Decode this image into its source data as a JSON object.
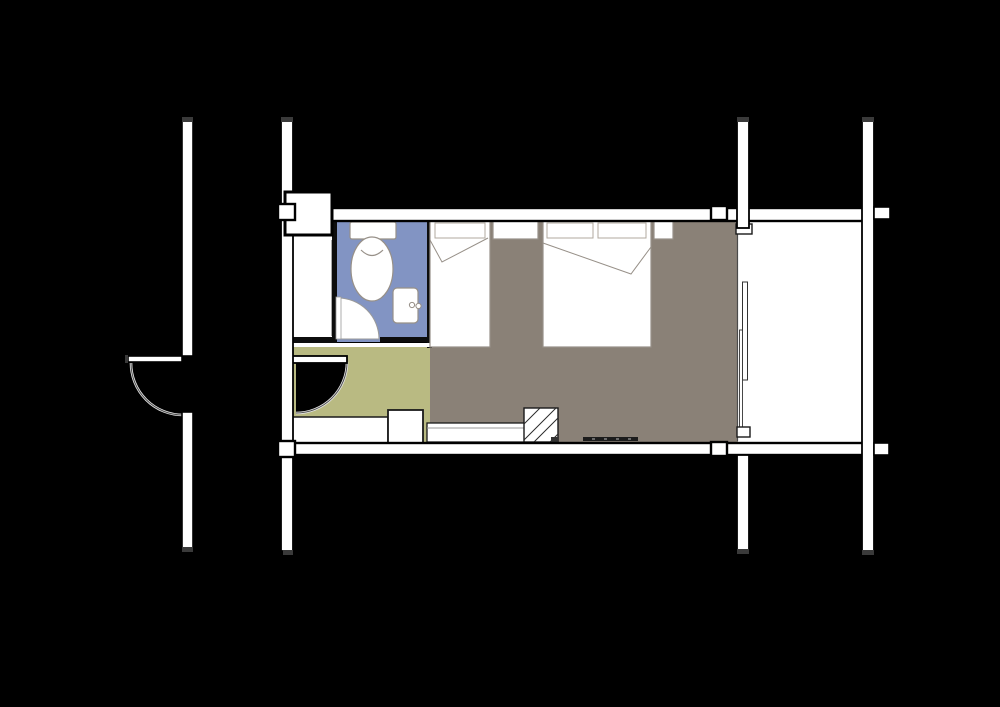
{
  "canvas": {
    "width": 1000,
    "height": 707
  },
  "colors": {
    "background": "#000000",
    "wall_fill": "#ffffff",
    "wall_outline": "#000000",
    "wall_cap": "#3a3a3a",
    "bathroom_floor": "#8294c3",
    "entry_floor": "#b9ba82",
    "bedroom_floor": "#8a8177",
    "balcony_floor": "#ffffff",
    "closet_floor": "#ffffff",
    "furniture_fill": "#ffffff",
    "furniture_outline": "#979088",
    "thin_wall": "#0d0d0d",
    "door_arc_light": "#e6e6e6",
    "door_arc_dark": "#4d4d4d",
    "tv_bar": "#1c1c1c",
    "tv_bar_tick": "#6a6a6a"
  },
  "regions": [
    {
      "name": "bathroom",
      "floor_color_key": "bathroom_floor"
    },
    {
      "name": "entry-hall",
      "floor_color_key": "entry_floor"
    },
    {
      "name": "bedroom",
      "floor_color_key": "bedroom_floor"
    },
    {
      "name": "balcony",
      "floor_color_key": "balcony_floor"
    },
    {
      "name": "closet",
      "floor_color_key": "closet_floor"
    },
    {
      "name": "corridor",
      "floor_color_key": "background"
    }
  ],
  "fixtures": [
    "toilet",
    "sink",
    "bathroom-door",
    "entry-door",
    "corridor-door",
    "single-bed",
    "double-bed",
    "nightstand",
    "nightstand",
    "counter",
    "desk",
    "luggage-rack",
    "tv-console",
    "sliding-glass-door",
    "service-shaft",
    "column"
  ]
}
